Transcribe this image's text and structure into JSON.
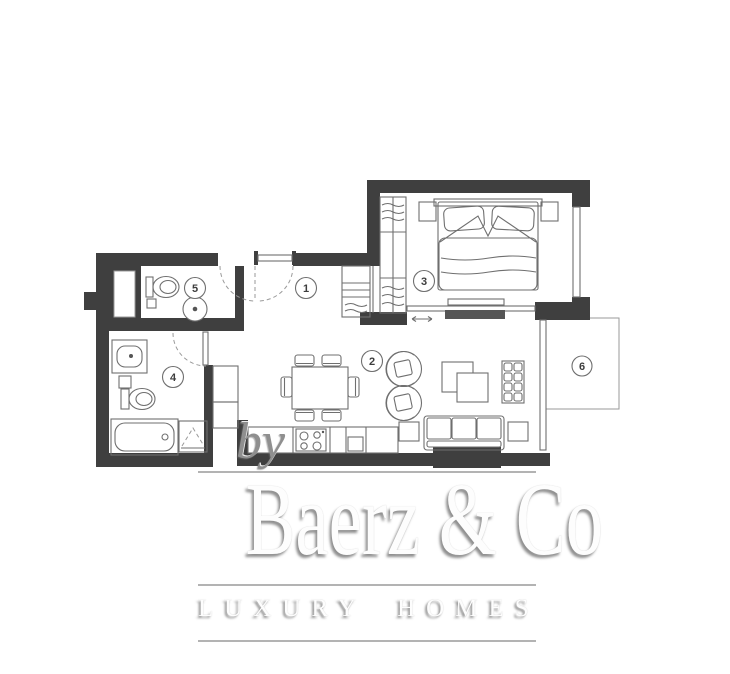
{
  "watermark": {
    "brand": "Baerz & Co",
    "tagline": "LUXURY HOMES",
    "byline": "by"
  },
  "rooms": [
    {
      "number": "1"
    },
    {
      "number": "2"
    },
    {
      "number": "3"
    },
    {
      "number": "4"
    },
    {
      "number": "5"
    },
    {
      "number": "6"
    }
  ],
  "colors": {
    "wall": "#3f3f3f",
    "line": "#6f6f6f",
    "light_line": "#9a9a9a",
    "label": "#3d3d3d",
    "wm_line": "#b3b3b3",
    "wm_text": "#fdfdfd",
    "byline": "#8f8f8f"
  }
}
